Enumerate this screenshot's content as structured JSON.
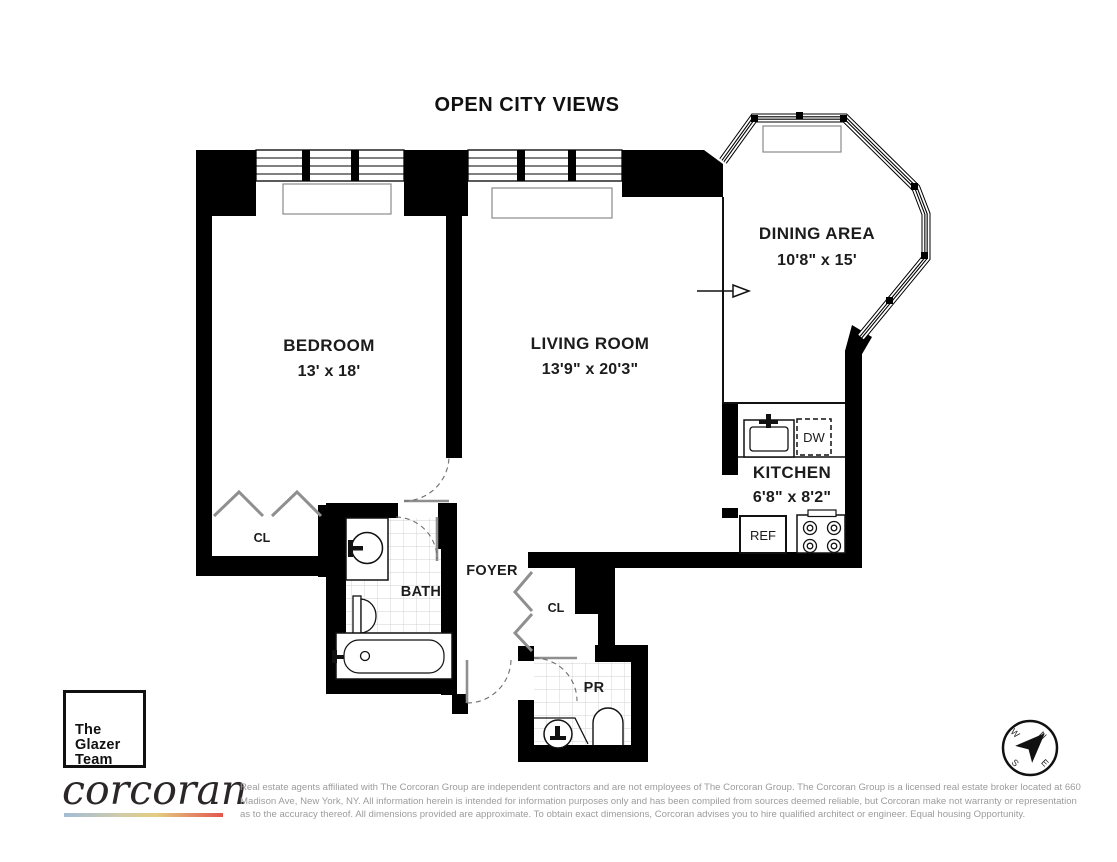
{
  "title": "OPEN CITY VIEWS",
  "rooms": {
    "bedroom": {
      "name": "BEDROOM",
      "dims": "13' x 18'"
    },
    "living_room": {
      "name": "LIVING ROOM",
      "dims": "13'9\" x 20'3\""
    },
    "dining_area": {
      "name": "DINING AREA",
      "dims": "10'8\" x 15'"
    },
    "kitchen": {
      "name": "KITCHEN",
      "dims": "6'8\" x 8'2\""
    },
    "bath": {
      "name": "BATH"
    },
    "foyer": {
      "name": "FOYER"
    },
    "powder_room": {
      "name": "PR"
    },
    "bedroom_closet": {
      "name": "CL"
    },
    "foyer_closet": {
      "name": "CL"
    }
  },
  "appliances": {
    "refrigerator": "REF",
    "dishwasher": "DW"
  },
  "compass": {
    "n": "N",
    "e": "E",
    "s": "S",
    "w": "W"
  },
  "branding": {
    "team": [
      "The",
      "Glazer",
      "Team"
    ],
    "brokerage": "corcoran"
  },
  "disclaimer": {
    "line1": "Real estate agents affiliated with The Corcoran Group are independent contractors and are not employees of The Corcoran Group. The Corcoran Group is a licensed real estate broker located at 660",
    "line2": "Madison Ave, New York, NY. All information herein is intended for information purposes only and has been compiled from sources deemed reliable, but Corcoran make not warranty or representation",
    "line3": "as to the accuracy thereof. All dimensions provided are approximate. To obtain exact dimensions, Corcoran advises you to hire qualified architect or engineer. Equal housing Opportunity."
  },
  "colors": {
    "wall": "#000000",
    "label_text": "#1c1c1c",
    "door": "#8f8f8f",
    "tile_grid": "#d0d0d0",
    "disclaimer_text": "#9c9c9c",
    "gradient_left": "#a3bcd6",
    "gradient_mid": "#e5cc80",
    "gradient_right": "#e2574e"
  }
}
